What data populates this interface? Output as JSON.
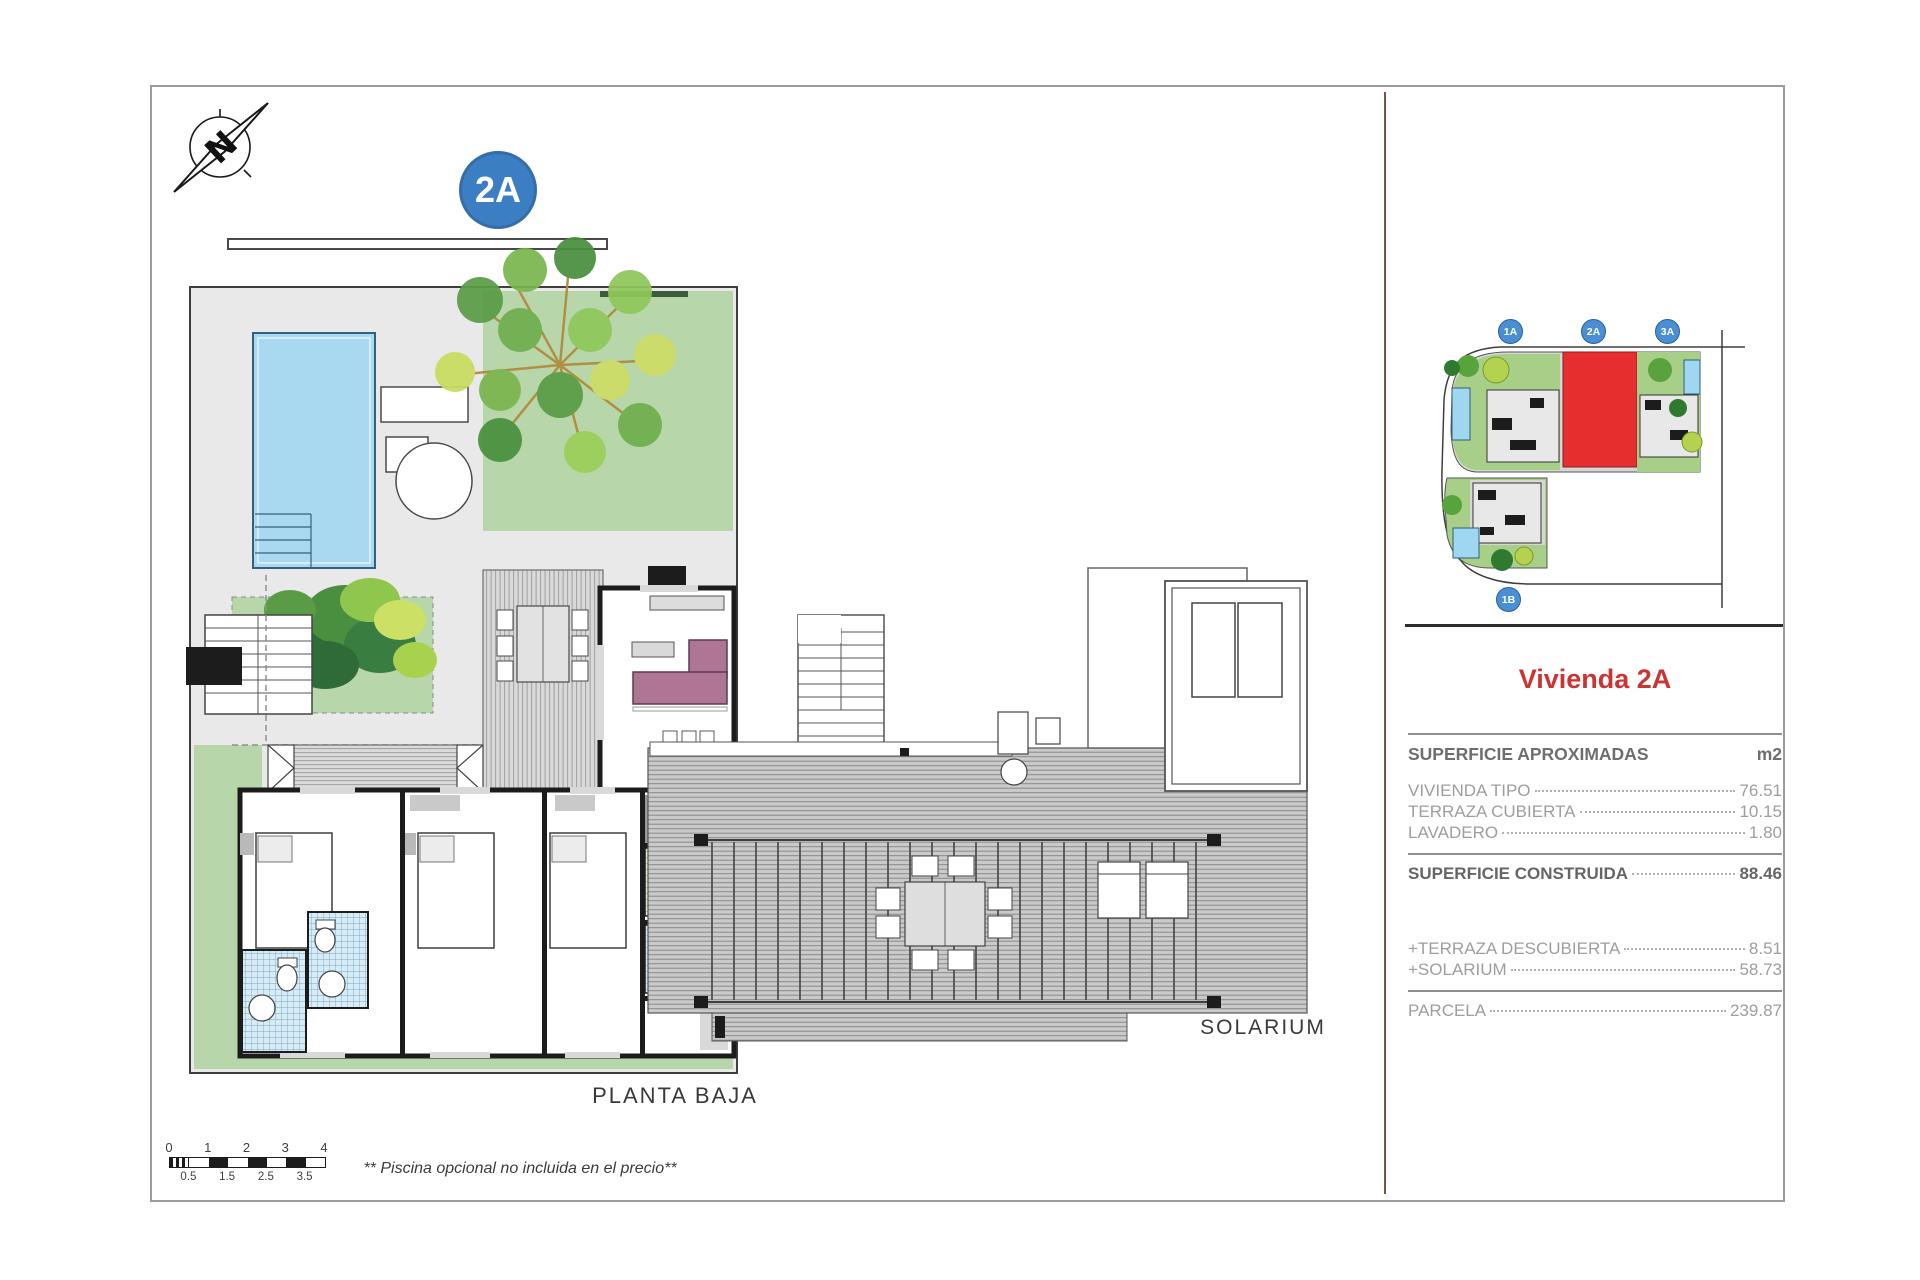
{
  "header": {
    "badge": "2A"
  },
  "north": {
    "letter": "N"
  },
  "plan_left": {
    "label": "PLANTA BAJA"
  },
  "plan_right": {
    "label": "SOLARIUM"
  },
  "footnote": "** Piscina opcional no incluida en el precio**",
  "scalebar": {
    "major": [
      "0",
      "1",
      "2",
      "3",
      "4"
    ],
    "minor": [
      "0.5",
      "1.5",
      "2.5",
      "3.5"
    ]
  },
  "siteplan": {
    "badges": [
      "1A",
      "2A",
      "3A",
      "1B"
    ],
    "highlight_plot": "2A",
    "highlight_color": "#e62e2e"
  },
  "panel": {
    "title": "Vivienda 2A",
    "title_color": "#cc3333",
    "table": {
      "header_label": "SUPERFICIE APROXIMADAS",
      "unit": "m2",
      "rows": [
        {
          "label": "VIVIENDA TIPO",
          "value": "76.51"
        },
        {
          "label": "TERRAZA CUBIERTA",
          "value": "10.15"
        },
        {
          "label": "LAVADERO",
          "value": "1.80"
        },
        {
          "label": "SUPERFICIE CONSTRUIDA",
          "value": "88.46"
        },
        {
          "label": "+TERRAZA DESCUBIERTA",
          "value": "8.51"
        },
        {
          "label": "+SOLARIUM",
          "value": "58.73"
        },
        {
          "label": "PARCELA",
          "value": "239.87"
        }
      ]
    }
  },
  "colors": {
    "badge_blue": "#3b7ec2",
    "site_badge_blue": "#4a8fd4",
    "garden_green": "#b7d7aa",
    "pool_blue": "#a9d9f0",
    "sofa_plum": "#ae7694",
    "divider_brown": "#7a524a"
  }
}
